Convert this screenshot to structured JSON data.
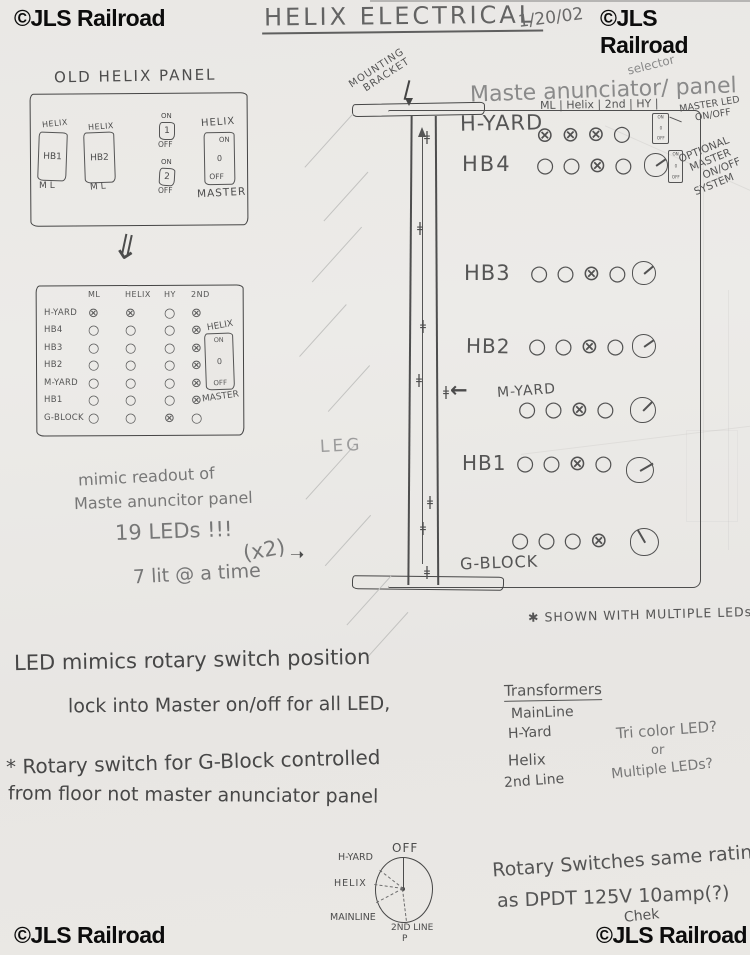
{
  "watermarks": {
    "text": "©JLS Railroad"
  },
  "header": {
    "title": "HELIX ELECTRICAL",
    "date": "1/20/02"
  },
  "icons": {
    "double_down_arrow": "⇓",
    "right_arrow": "➝",
    "left_arrow": "←",
    "connector": "ǂ"
  },
  "old_panel": {
    "label": "OLD HELIX PANEL",
    "hb1": {
      "top": "HELIX",
      "name": "HB1",
      "bottom": "ML"
    },
    "hb2": {
      "top": "HELIX",
      "name": "HB2",
      "bottom": "ML"
    },
    "sw1": {
      "on": "ON",
      "num": "1",
      "off": "OFF"
    },
    "sw2": {
      "on": "ON",
      "num": "2",
      "off": "OFF"
    },
    "master": {
      "top": "HELIX",
      "on": "ON",
      "mid": "0",
      "off": "OFF",
      "bottom": "MASTER"
    }
  },
  "mimic_table": {
    "columns": [
      "ML",
      "HELIX",
      "HY",
      "2ND"
    ],
    "rows": [
      {
        "label": "H-YARD",
        "marks": [
          "⊗",
          "⊗",
          "○",
          "⊗"
        ]
      },
      {
        "label": "HB4",
        "marks": [
          "○",
          "○",
          "○",
          "⊗"
        ]
      },
      {
        "label": "HB3",
        "marks": [
          "○",
          "○",
          "○",
          "⊗"
        ]
      },
      {
        "label": "HB2",
        "marks": [
          "○",
          "○",
          "○",
          "⊗"
        ]
      },
      {
        "label": "M-YARD",
        "marks": [
          "○",
          "○",
          "○",
          "⊗"
        ]
      },
      {
        "label": "HB1",
        "marks": [
          "○",
          "○",
          "○",
          "⊗"
        ]
      },
      {
        "label": "G-BLOCK",
        "marks": [
          "○",
          "○",
          "⊗",
          "○"
        ]
      }
    ],
    "master": {
      "top": "HELIX",
      "on": "ON",
      "mid": "0",
      "off": "OFF",
      "bottom": "MASTER"
    }
  },
  "mimic_notes": {
    "line1": "mimic readout of",
    "line2": "Maste anuncitor panel",
    "line3": "19 LEDs !!!",
    "x2": "(x2)",
    "line4": "7 lit @ a time"
  },
  "master_panel": {
    "mounting_line1": "MOUNTING",
    "mounting_line2": "BRACKET",
    "title_part1": "Maste anunciator",
    "title_caret": "/",
    "title_insert": "selector",
    "title_part2": "panel",
    "leg_label": "LEG",
    "columns_header": "ML | Helix | 2nd | HY |",
    "master_led_line1": "MASTER LED",
    "master_led_line2": "ON/OFF",
    "master_led_switch": {
      "on": "ON",
      "mid": "0",
      "off": "OFF"
    },
    "mini_switch": {
      "on": "ON",
      "mid": "0",
      "off": "OFF"
    },
    "optional_lines": [
      "OPTIONAL",
      "MASTER",
      "ON/OFF",
      "SYSTEM"
    ],
    "rows": [
      {
        "label": "H-YARD",
        "marks": "⊗⊗⊗○"
      },
      {
        "label": "HB4",
        "marks": "○○⊗○"
      },
      {
        "label": "HB3",
        "marks": "○○⊗○"
      },
      {
        "label": "HB2",
        "marks": "○○⊗○"
      },
      {
        "label": "M-YARD",
        "marks": "○○⊗○"
      },
      {
        "label": "HB1",
        "marks": "○○⊗○"
      },
      {
        "label": "G-BLOCK",
        "marks": "○○○⊗"
      }
    ],
    "footnote": "✱ SHOWN WITH MULTIPLE LEDs"
  },
  "notes_left": {
    "line1": "LED mimics rotary switch position",
    "line2": "lock into Master on/off for all LED,",
    "line3": "* Rotary switch for G-Block controlled",
    "line4": "from floor not master anunciator panel"
  },
  "transformers": {
    "title": "Transformers",
    "items": [
      "MainLine",
      "H-Yard",
      "Helix",
      "2nd Line"
    ]
  },
  "led_question": {
    "line1": "Tri color LED?",
    "line2": "or",
    "line3": "Multiple LEDs?"
  },
  "rotary_diagram": {
    "off": "OFF",
    "h_yard": "H-YARD",
    "helix": "HELIX",
    "mainline": "MAINLINE",
    "second_line": "2ND LINE",
    "p": "P"
  },
  "rotary_note": {
    "line1": "Rotary Switches same rating",
    "line2": "as DPDT  125V 10amp(?)",
    "line3": "Chek"
  }
}
